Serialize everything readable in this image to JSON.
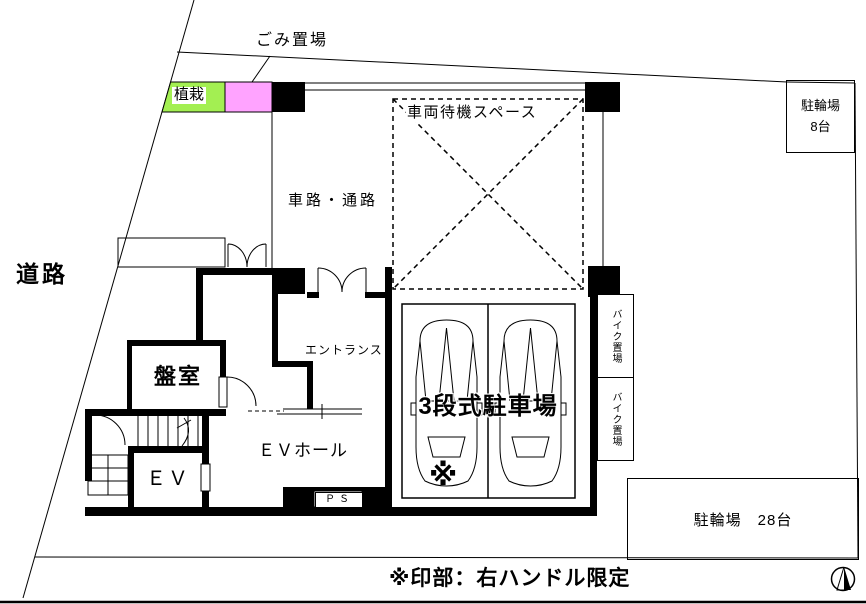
{
  "plan": {
    "site": {
      "road": "道路",
      "garbage_area": "ごみ置場",
      "planting": "植栽",
      "bottom_note": "※印部：右ハンドル限定"
    },
    "areas": {
      "driveway": "車路・通路",
      "vehicle_waiting_space": "車両待機スペース",
      "bicycle_parking_small_name": "駐輪場",
      "bicycle_parking_small_capacity": "8台",
      "bike_parking_upper": "バイク置場",
      "bike_parking_lower": "バイク置場",
      "triple_parking": "3段式駐車場",
      "asterisk_mark": "※",
      "bicycle_parking_large": "駐輪場　28台"
    },
    "rooms": {
      "entrance": "エントランス",
      "panel_room": "盤室",
      "ev_hall": "ＥＶホール",
      "elevator": "ＥＶ",
      "pipe_space": "ＰＳ"
    },
    "colors": {
      "planting": "#A3EF52",
      "garbage_box": "#FFA3FF",
      "wall": "#000000"
    }
  }
}
